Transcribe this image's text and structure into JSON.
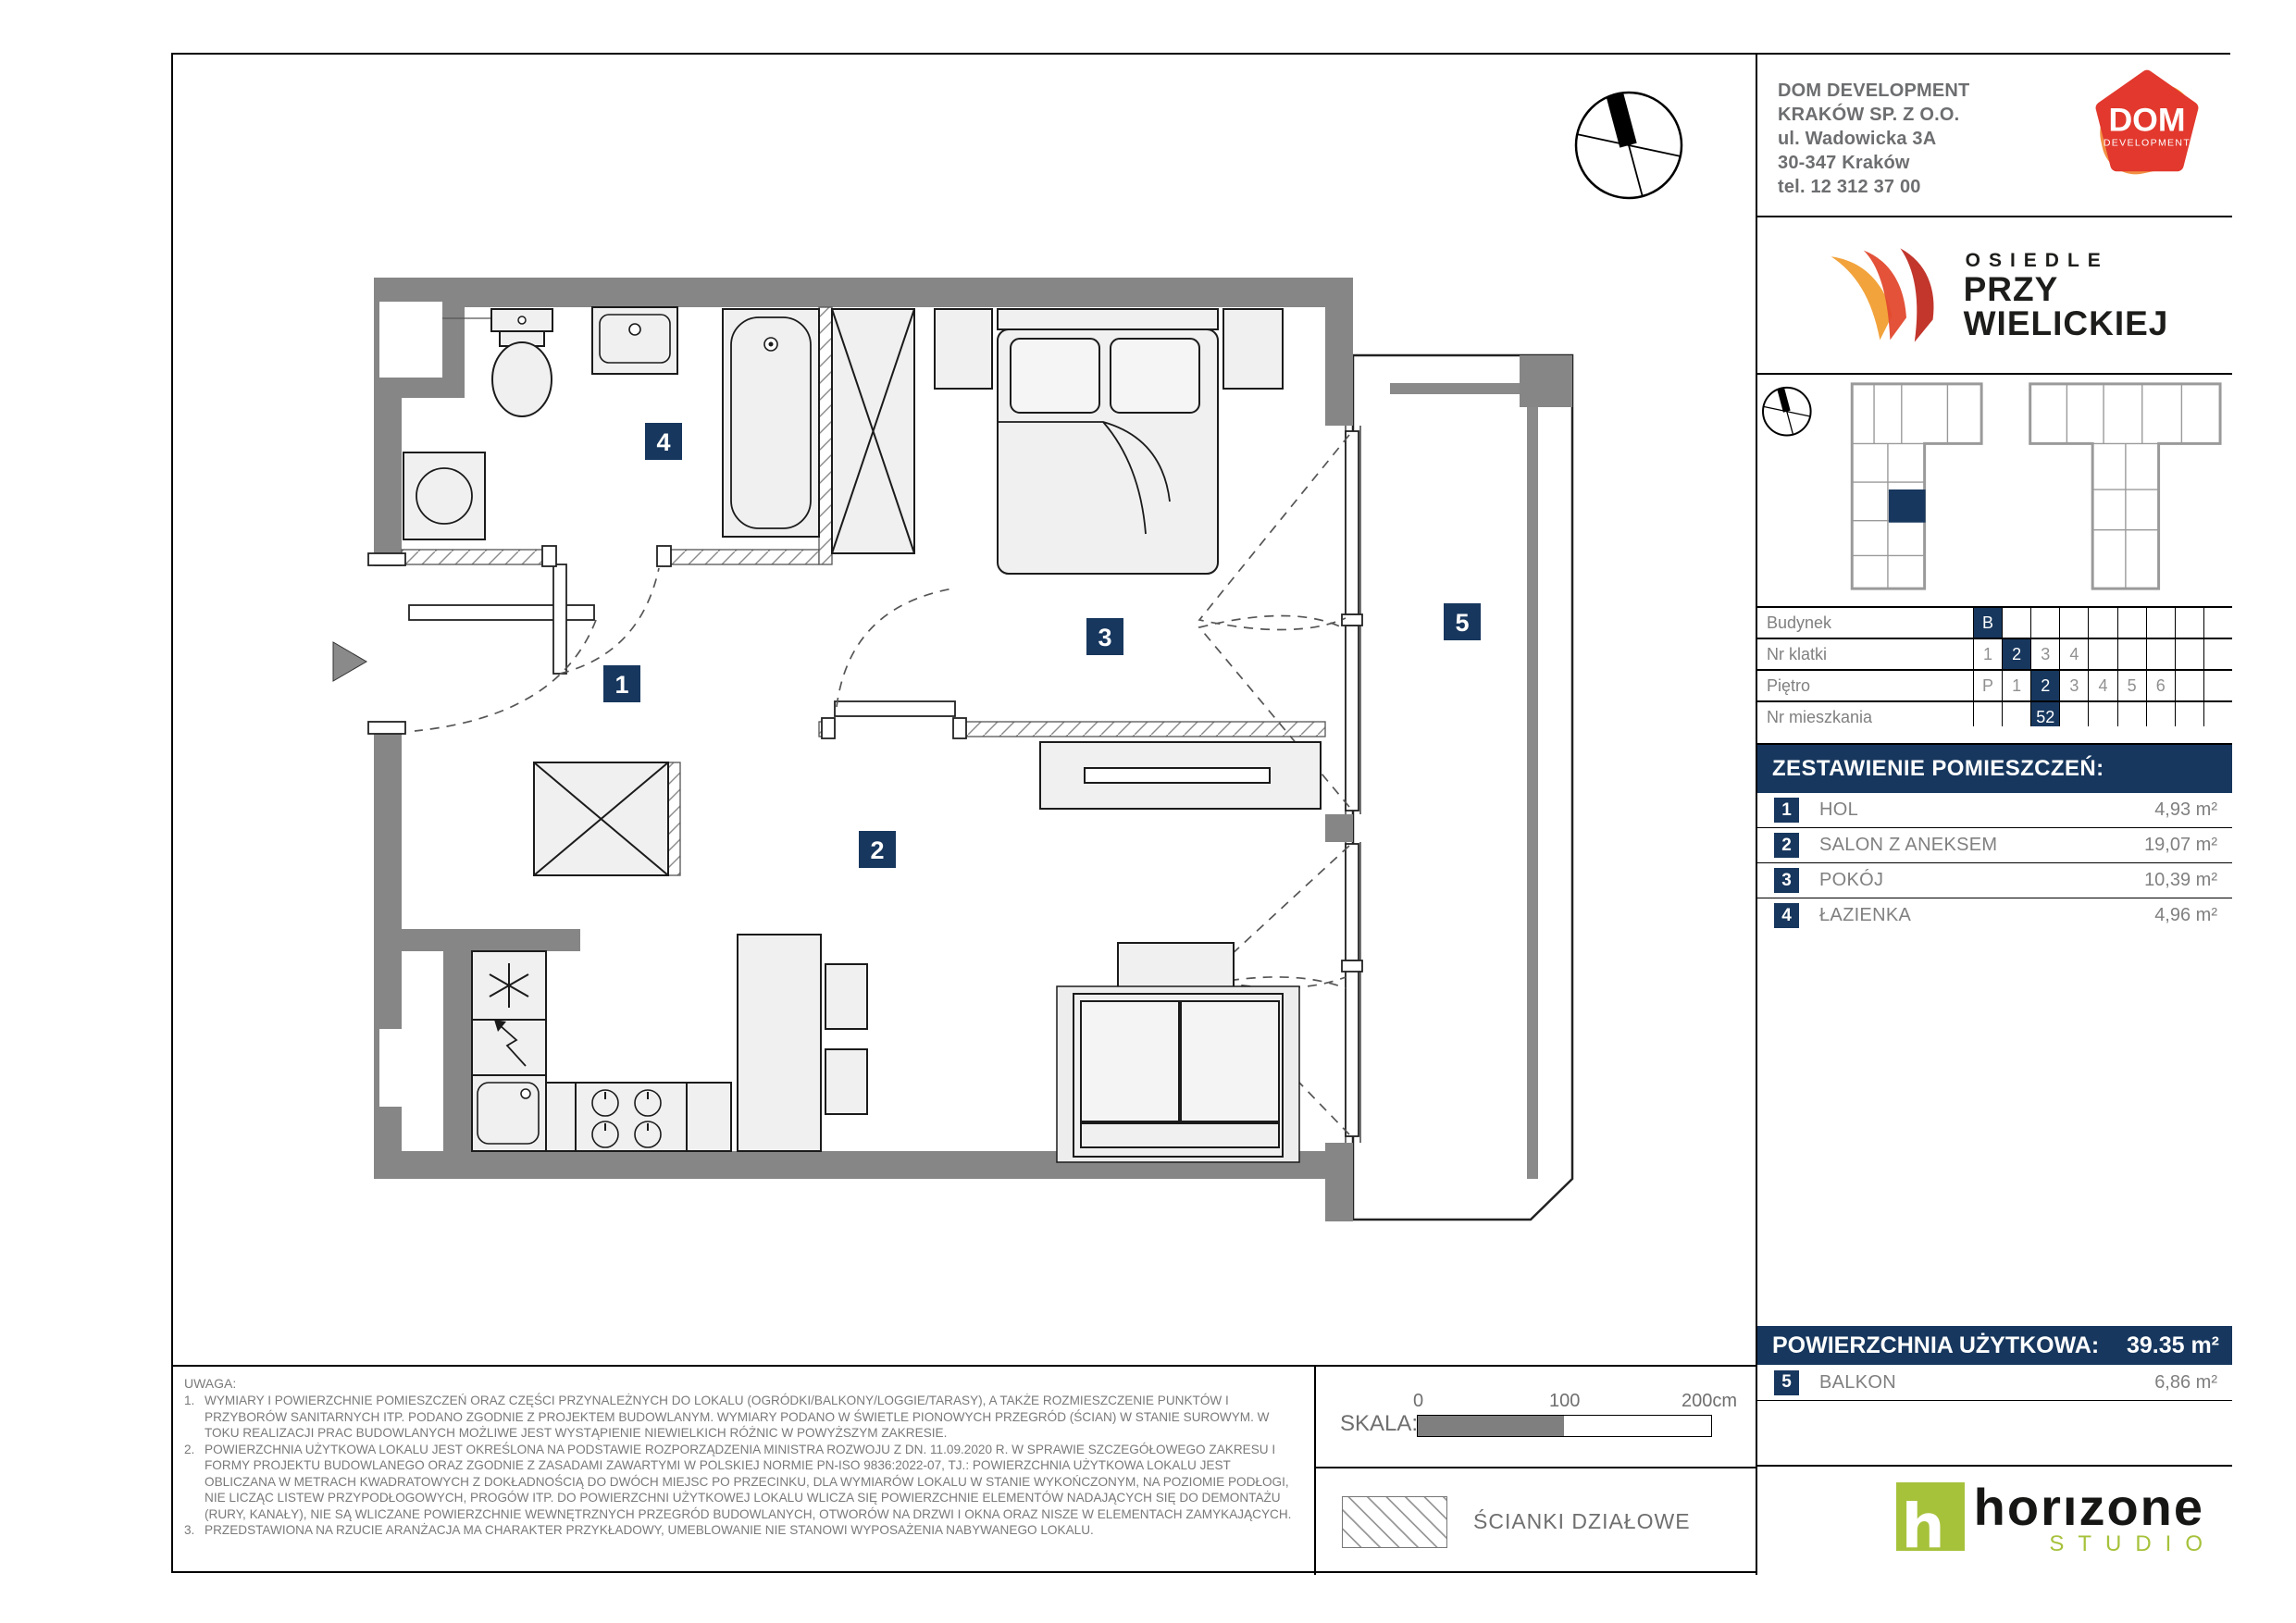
{
  "company": {
    "lines": [
      "DOM DEVELOPMENT",
      "KRAKÓW SP. Z O.O.",
      "ul. Wadowicka 3A",
      "30-347 Kraków",
      "tel. 12 312 37 00"
    ],
    "logo": {
      "title": "DOM",
      "subtitle": "DEVELOPMENT"
    }
  },
  "estate_logo": {
    "line1": "OSIEDLE",
    "line2": "PRZY",
    "line3": "WIELICKIEJ"
  },
  "location_table": {
    "rows": [
      {
        "label": "Budynek",
        "cells": [
          "B",
          "",
          "",
          "",
          "",
          "",
          "",
          "",
          ""
        ]
      },
      {
        "label": "Nr klatki",
        "cells": [
          "1",
          "2",
          "3",
          "4",
          "",
          "",
          "",
          "",
          ""
        ]
      },
      {
        "label": "Piętro",
        "cells": [
          "P",
          "1",
          "2",
          "3",
          "4",
          "5",
          "6",
          "",
          ""
        ]
      },
      {
        "label": "Nr mieszkania",
        "cells": [
          "",
          "",
          "52",
          "",
          "",
          "",
          "",
          "",
          ""
        ]
      }
    ]
  },
  "rooms": {
    "header": "ZESTAWIENIE POMIESZCZEŃ:",
    "items": [
      {
        "no": "1",
        "name": "HOL",
        "area": "4,93 m²"
      },
      {
        "no": "2",
        "name": "SALON Z ANEKSEM",
        "area": "19,07 m²"
      },
      {
        "no": "3",
        "name": "POKÓJ",
        "area": "10,39 m²"
      },
      {
        "no": "4",
        "name": "ŁAZIENKA",
        "area": "4,96 m²"
      }
    ]
  },
  "total": {
    "label": "POWIERZCHNIA UŻYTKOWA:",
    "value": "39.35 m²"
  },
  "balcony": {
    "no": "5",
    "name": "BALKON",
    "area": "6,86 m²"
  },
  "notes": {
    "title": "UWAGA:",
    "items": [
      {
        "no": "1.",
        "text": "WYMIARY I POWIERZCHNIE POMIESZCZEŃ ORAZ CZĘŚCI PRZYNALEŻNYCH DO LOKALU (OGRÓDKI/BALKONY/LOGGIE/TARASY), A TAKŻE ROZMIESZCZENIE PUNKTÓW I PRZYBORÓW SANITARNYCH ITP. PODANO ZGODNIE Z PROJEKTEM BUDOWLANYM. WYMIARY PODANO W ŚWIETLE PIONOWYCH PRZEGRÓD (ŚCIAN) W STANIE SUROWYM. W TOKU REALIZACJI PRAC BUDOWLANYCH MOŻLIWE JEST WYSTĄPIENIE NIEWIELKICH RÓŻNIC W POWYŻSZYM ZAKRESIE."
      },
      {
        "no": "2.",
        "text": "POWIERZCHNIA UŻYTKOWA LOKALU JEST OKREŚLONA NA PODSTAWIE ROZPORZĄDZENIA MINISTRA ROZWOJU Z DN. 11.09.2020 R. W SPRAWIE SZCZEGÓŁOWEGO ZAKRESU I FORMY PROJEKTU BUDOWLANEGO ORAZ ZGODNIE Z ZASADAMI ZAWARTYMI W POLSKIEJ NORMIE PN-ISO 9836:2022-07, TJ.: POWIERZCHNIA UŻYTKOWA LOKALU JEST OBLICZANA W METRACH KWADRATOWYCH Z DOKŁADNOŚCIĄ DO DWÓCH MIEJSC PO PRZECINKU, DLA WYMIARÓW LOKALU W STANIE WYKOŃCZONYM, NA POZIOMIE PODŁOGI, NIE LICZĄC LISTEW PRZYPODŁOGOWYCH, PROGÓW ITP. DO POWIERZCHNI UŻYTKOWEJ LOKALU WLICZA SIĘ POWIERZCHNIE ELEMENTÓW NADAJĄCYCH SIĘ DO DEMONTAŻU (RURY, KANAŁY), NIE SĄ WLICZANE POWIERZCHNIE WEWNĘTRZNYCH PRZEGRÓD BUDOWLANYCH, OTWORÓW NA DRZWI I OKNA ORAZ NISZE W ELEMENTACH ZAMYKAJĄCYCH."
      },
      {
        "no": "3.",
        "text": "PRZEDSTAWIONA NA RZUCIE ARANŻACJA MA CHARAKTER PRZYKŁADOWY, UMEBLOWANIE NIE STANOWI WYPOSAŻENIA NABYWANEGO LOKALU."
      }
    ]
  },
  "scalebar": {
    "label": "SKALA:",
    "tick0": "0",
    "tick100": "100",
    "tick200": "200cm"
  },
  "legend": {
    "partition_label": "ŚCIANKI DZIAŁOWE"
  },
  "studio_logo": {
    "name": "horızone",
    "sub": "STUDIO",
    "glyph": "h"
  },
  "plan": {
    "badges": [
      "1",
      "2",
      "3",
      "4",
      "5"
    ]
  },
  "colors": {
    "accent": "#17375e",
    "wall": "#868686",
    "dom_red": "#e2382d",
    "dom_orange": "#f4a428",
    "studio_green": "#a6c23b"
  }
}
